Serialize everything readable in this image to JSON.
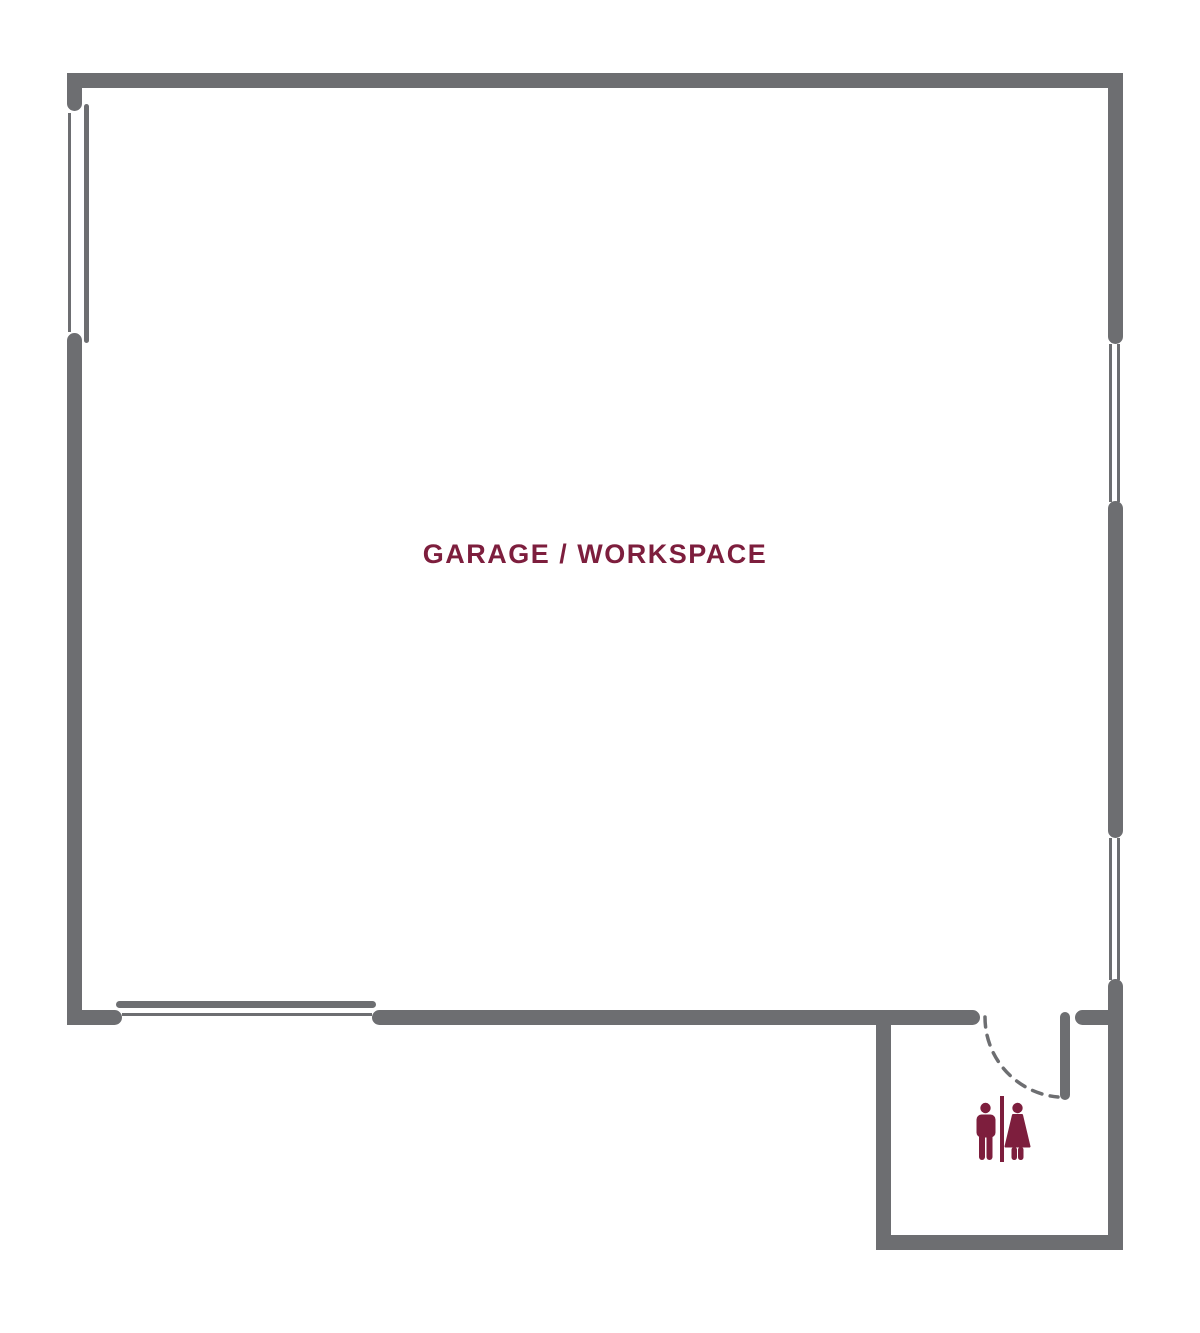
{
  "colors": {
    "wall": "#6d6e71",
    "accent": "#7d1e3d",
    "background": "#ffffff"
  },
  "rooms": {
    "garage": {
      "label": "GARAGE / WORKSPACE"
    },
    "restroom": {
      "icon": "restroom-men-women-icon"
    }
  },
  "features": {
    "garage_door": "wide-opening-bottom-left",
    "restroom_door": "swing-door-dashed-arc",
    "windows": [
      "left-wall-upper",
      "right-wall-upper",
      "right-wall-lower"
    ]
  }
}
